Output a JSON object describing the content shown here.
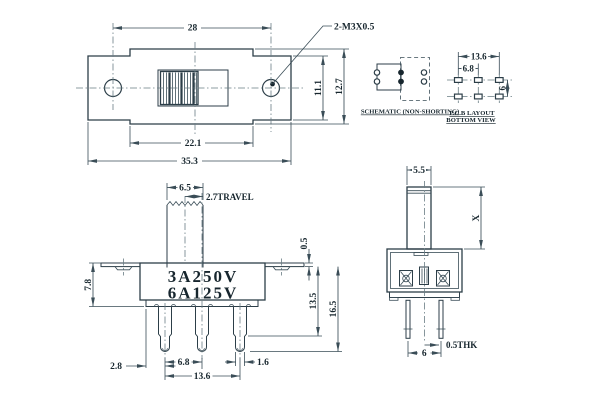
{
  "colors": {
    "background": "#ffffff",
    "outline": "#2c3e48",
    "dimension": "#3a4d57",
    "centerline": "#6a7d84",
    "text": "#17262e"
  },
  "top_view": {
    "dim_hole_spacing": "28",
    "hole_callout": "2-M3X0.5",
    "dim_end_height": "11.1",
    "dim_body_height": "12.7",
    "dim_inner_width": "22.1",
    "dim_overall_width": "35.3"
  },
  "schematic": {
    "caption": "SCHEMATIC (NON-SHORTING)"
  },
  "pcb_layout": {
    "caption_line1": "P.C.B LAYOUT",
    "caption_line2": "BOTTOM VIEW",
    "dim_pad_span": "13.6",
    "dim_pad_pitch": "6.8",
    "dim_row_pitch": "6"
  },
  "front_view": {
    "marking_line1": "3A250V",
    "marking_line2": "6A125V",
    "dim_knob_width": "6.5",
    "dim_travel": "2.7TRAVEL",
    "dim_bracket_height": "7.8",
    "dim_bracket_thickness": "0.5",
    "dim_pin_depth": "13.5",
    "dim_overall_height": "16.5",
    "dim_edge_to_pin": "2.8",
    "dim_pin_pitch": "6.8",
    "dim_pin_span": "13.6",
    "dim_pin_width": "1.6"
  },
  "side_view": {
    "dim_knob_depth": "5.5",
    "dim_knob_height": "X",
    "dim_pin_spacing": "6",
    "dim_pin_thickness": "0.5THK"
  }
}
